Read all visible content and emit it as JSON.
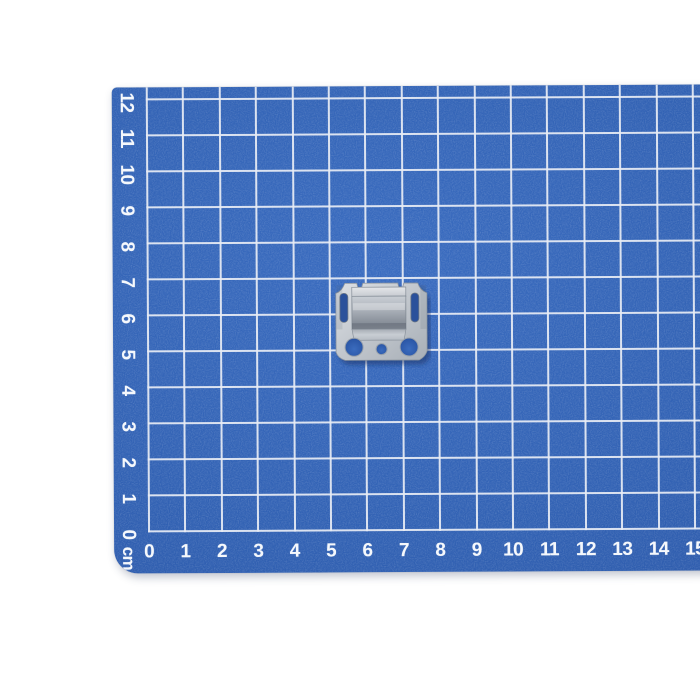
{
  "scene": {
    "background_color": "#ffffff",
    "description": "Small galvanized steel mounting clip lying on a blue self-healing cutting mat with a white 1 cm grid"
  },
  "mat": {
    "base_color": "#3262b4",
    "grid_line_color": "#e7ecf4",
    "label_color": "#f5f8fc",
    "unit_label": "cm",
    "bottom_ruler_labels": [
      "0",
      "1",
      "2",
      "3",
      "4",
      "5",
      "6",
      "7",
      "8",
      "9",
      "10",
      "11",
      "12",
      "13",
      "14",
      "15"
    ],
    "left_ruler_labels": [
      "0",
      "1",
      "2",
      "3",
      "4",
      "5",
      "6",
      "7",
      "8",
      "9",
      "10",
      "11",
      "12"
    ]
  },
  "object": {
    "name": "galvanized-steel-clip",
    "description": "Stamped metal clip with raised rectangular center, two side slots, two large round holes and one small round hole",
    "approx_size_cm": {
      "width": 2.5,
      "height": 2.1
    }
  }
}
